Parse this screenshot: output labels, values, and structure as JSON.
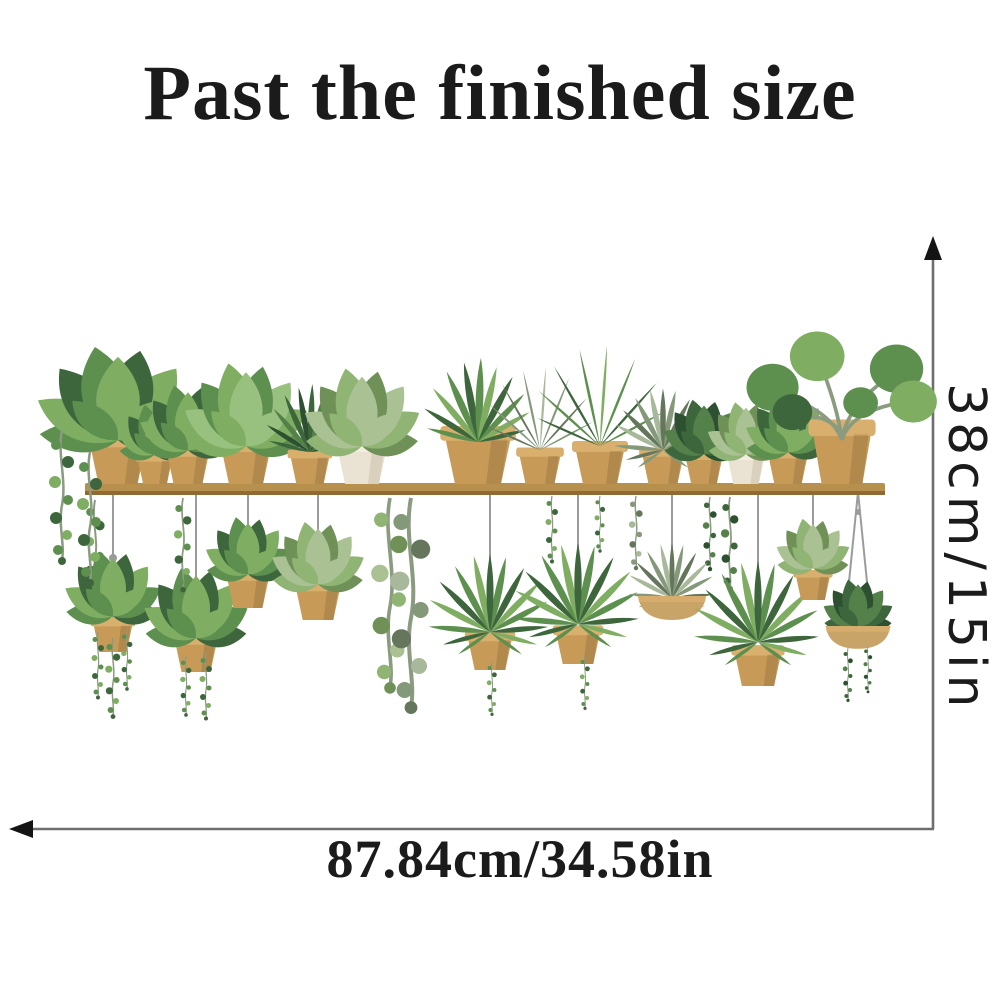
{
  "title": "Past the finished size",
  "dimension_labels": {
    "height": "38cm/15in",
    "width": "87.84cm/34.58in"
  },
  "illustration": {
    "description": "Wall sticker of a wooden shelf with green potted plants on top and hanging planters below"
  },
  "colors": {
    "background": "#ffffff",
    "text": "#1b1b1b",
    "dimension_line": "#6e6e6e",
    "arrowhead": "#141414",
    "shelf": "#b8904e",
    "shelf_edge": "#8f6a33",
    "pot": "#c79a58",
    "pot_rim": "#d9af6e",
    "pot_white": "#eae2d2",
    "basket": "#c8a468",
    "string": "#9b9b9b",
    "leaf_dark": "#3e663c",
    "leaf_mid": "#5d8f4e",
    "leaf_light": "#7fae62",
    "leaf_pale": "#a9c193",
    "leaf_gray": "#84987a",
    "stem": "#8a9b80"
  }
}
